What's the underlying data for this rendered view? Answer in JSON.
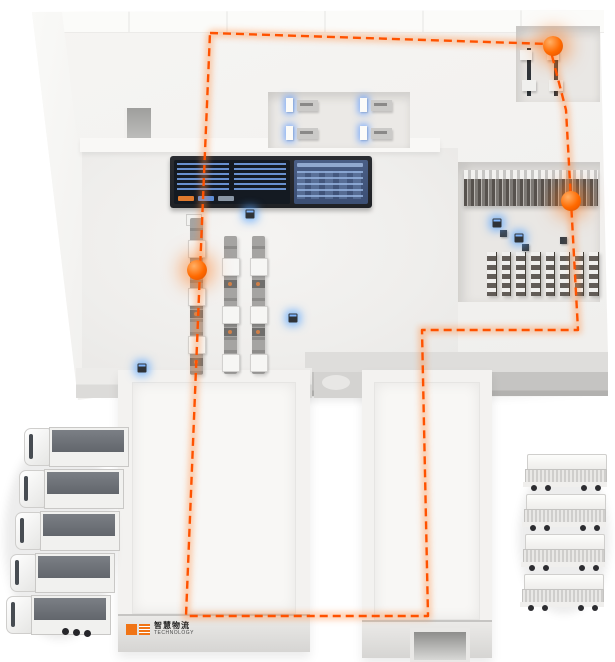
{
  "brand": {
    "name": "智慧物流",
    "tagline": "TECHNOLOGY",
    "mark": "orange-square-logo"
  },
  "colors": {
    "route_accent": "#ff5200",
    "route_glow": "#ff8a3c",
    "node_orange": "#ff6a00",
    "sensor_blue": "#4da6ff",
    "building_white": "#f4f3f1",
    "front_wall_gray": "#c5c4c2",
    "screen_dark": "#141a22",
    "screen_blue": "#5d8ed8"
  },
  "route": {
    "style": "dashed-loop",
    "points": "210,33 549,44 566,110 571,201 578,330 422,330 428,616 186,616 200,270 210,33"
  },
  "markers": {
    "agv_nodes": [
      {
        "x": 553,
        "y": 46
      },
      {
        "x": 571,
        "y": 201
      },
      {
        "x": 197,
        "y": 270
      }
    ],
    "sensors": [
      {
        "x": 250,
        "y": 214
      },
      {
        "x": 293,
        "y": 318
      },
      {
        "x": 142,
        "y": 368
      },
      {
        "x": 497,
        "y": 223
      },
      {
        "x": 519,
        "y": 238
      }
    ]
  },
  "fleet": {
    "left_trucks": [
      {
        "x": 18,
        "y": 0
      },
      {
        "x": 13,
        "y": 42
      },
      {
        "x": 9,
        "y": 84
      },
      {
        "x": 4,
        "y": 126
      },
      {
        "x": 0,
        "y": 168
      }
    ],
    "right_trucks": [
      {
        "x": 3,
        "y": 0
      },
      {
        "x": 2,
        "y": 40
      },
      {
        "x": 1,
        "y": 80
      },
      {
        "x": 0,
        "y": 120
      }
    ]
  },
  "equipment": {
    "control_dashboard": 1,
    "conveyor_lines": 3,
    "rack_wall_sections": 1,
    "rack_columns": 8,
    "workstations": 4,
    "dock_machines": 2,
    "dock_ramps": 2
  }
}
